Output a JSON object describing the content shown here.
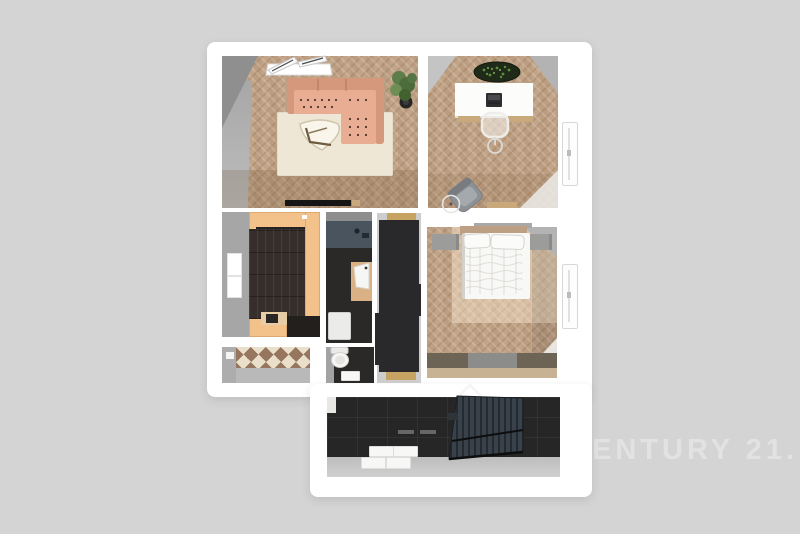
{
  "image_type": "3d-floor-plan-render",
  "watermark": {
    "text": "ENTURY 21.",
    "color": "#e2e2e2"
  },
  "palette": {
    "background": "#d4d4d4",
    "wall_white": "#ffffff",
    "floor_wood": "#c2a488",
    "sofa_salmon": "#e8ad92",
    "kitchen_counter_orange": "#f2c28a",
    "dark_floor": "#262626",
    "plant_green": "#5d7d49",
    "bed_white": "#f8f8f7",
    "stairs_dark": "#39424a",
    "checker_brown": "#97765f",
    "checker_cream": "#eadfcb",
    "vanity_wood": "#d9b184",
    "wardrobe_black": "#29292b",
    "hall_cap_tan": "#c6a263"
  },
  "rooms": [
    {
      "name": "living-room",
      "furniture": [
        "sectional-sofa",
        "rug",
        "coffee-table",
        "plant",
        "tv-lowboard",
        "roof-windows"
      ]
    },
    {
      "name": "office",
      "furniture": [
        "desk",
        "laptop",
        "desk-chair",
        "armchair",
        "floor-lamp",
        "oval-plant",
        "window",
        "sideboard"
      ]
    },
    {
      "name": "kitchen",
      "furniture": [
        "l-shaped-counter",
        "appliances",
        "sink",
        "window"
      ]
    },
    {
      "name": "pantry",
      "furniture": [
        "checkered-floor",
        "light-switch"
      ]
    },
    {
      "name": "bathroom",
      "furniture": [
        "counter-with-faucet",
        "vanity-sink",
        "washing-machine"
      ]
    },
    {
      "name": "wc",
      "furniture": [
        "toilet",
        "mat"
      ]
    },
    {
      "name": "hallway",
      "furniture": [
        "wardrobe"
      ]
    },
    {
      "name": "bedroom",
      "furniture": [
        "double-bed",
        "pillows",
        "nightstand-left",
        "nightstand-right",
        "rug",
        "window"
      ]
    },
    {
      "name": "entrance-hall",
      "furniture": [
        "stairs",
        "doormats"
      ]
    }
  ]
}
